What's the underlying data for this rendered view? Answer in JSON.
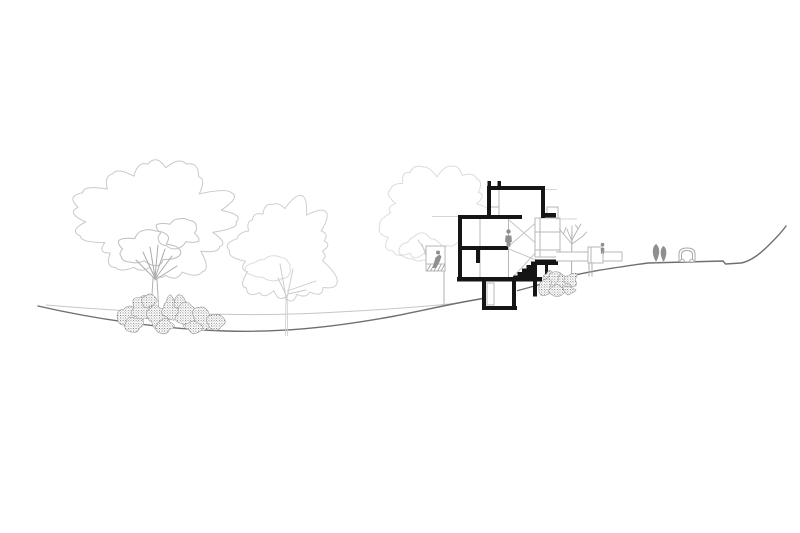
{
  "canvas": {
    "width": 800,
    "height": 533,
    "background": "#ffffff"
  },
  "palette": {
    "paper": "#ffffff",
    "section_black": "#151515",
    "wall_gray": "#b7b7b7",
    "light_gray": "#d6d6d6",
    "ground_dark": "#6f6f6f",
    "ground_light": "#c6c6c6",
    "figure_gray": "#8f8f8f",
    "tree_outline": "#c9c9c9",
    "tree_outline_faint": "#dcdcdc",
    "branch_gray": "#ababab",
    "shrub_stroke": "#9a9a9a",
    "shrub_dot": "#4a4a4a",
    "poplar_fill": "#8f8f8f",
    "car_outline": "#a9a9a9"
  },
  "scene": {
    "type": "architectural-site-section-drawing",
    "elements": [
      {
        "name": "ground-profile",
        "style": "dark continuous terrain line sloping from a swale at left up to a hill at far right"
      },
      {
        "name": "grade-reference-line",
        "style": "light secondary grade line on the left half"
      },
      {
        "name": "large-deciduous-tree",
        "style": "light scribbled canopy outline with fanned branches and double-line trunk"
      },
      {
        "name": "medium-deciduous-tree",
        "style": "very light canopy outline with thin trunk"
      },
      {
        "name": "background-tree-behind-house",
        "style": "faint canopy partially hidden by the building"
      },
      {
        "name": "house-section",
        "style": "multi-level house cut in solid black: roof tower, two floors, sunken basement, solid black stair"
      },
      {
        "name": "side-annex",
        "style": "gray outlined volumes right of the tower"
      },
      {
        "name": "balcony-with-figure",
        "style": "small railed balcony on the left facade with a leaning human figure"
      },
      {
        "name": "interior-figure",
        "style": "standing human silhouette on the upper floor"
      },
      {
        "name": "deck-walkway",
        "style": "thin horizontal deck extending right with planter box and small figure"
      },
      {
        "name": "bare-tree",
        "style": "leafless branching tree behind the deck"
      },
      {
        "name": "shrub-cluster-left",
        "style": "stippled bushes at the base of the large tree"
      },
      {
        "name": "shrub-cluster-right",
        "style": "stippled bushes on the slope below the stair"
      },
      {
        "name": "poplar-pair",
        "style": "two small solid gray trees on the right plateau"
      },
      {
        "name": "car",
        "style": "small rounded car outline on the right plateau"
      }
    ],
    "figure_count": 3,
    "text_labels": []
  }
}
